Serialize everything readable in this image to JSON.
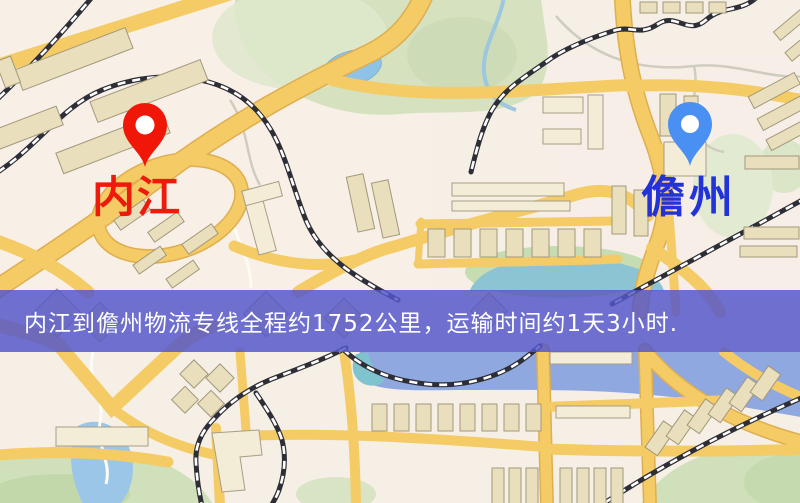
{
  "map": {
    "kind": "logistics-route-map",
    "origin": {
      "label": "内江",
      "pin_color": "#f11708",
      "text_color": "#ee1a0c"
    },
    "destination": {
      "label": "儋州",
      "pin_color": "#4a90f2",
      "text_color": "#2433d8"
    },
    "banner": {
      "text": "内江到儋州物流专线全程约1752公里，运输时间约1天3小时.",
      "bg_color": "#5356c9",
      "text_color": "#ffffff",
      "distance_km": "1752",
      "duration": "1天3小时"
    },
    "palette": {
      "background": "#f6efe5",
      "road": "#f4cb64",
      "park_green": "#d5e1bf",
      "water_blue": "#8fc3e6",
      "river_blue": "#8fa8e0",
      "railway_dark": "#2e2e36",
      "building_tan": "#e9dfbc"
    }
  }
}
